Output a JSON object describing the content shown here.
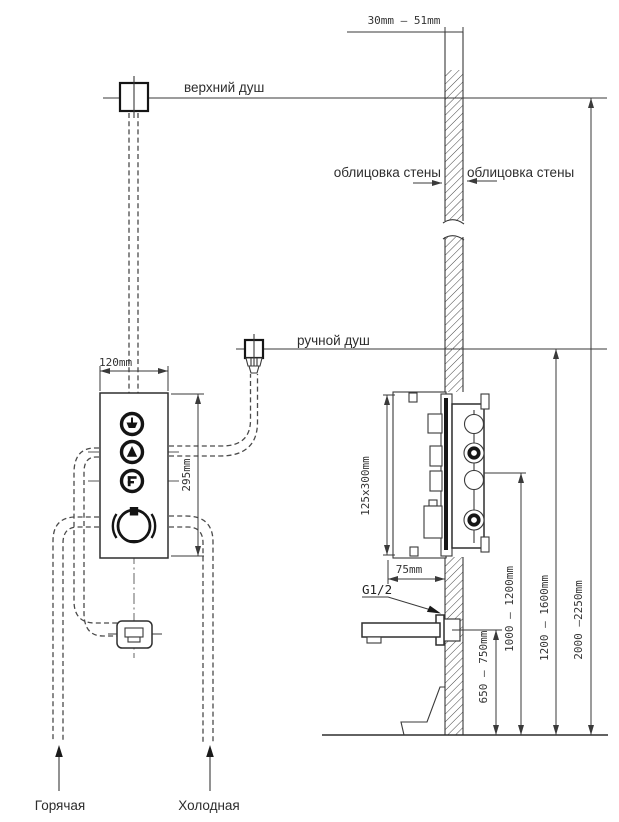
{
  "title": "Схема установки душевой панели",
  "labels": {
    "top_shower": "верхний душ",
    "hand_shower": "ручной душ",
    "wall_cladding_left": "облицовка стены",
    "wall_cladding_right": "облицовка стены",
    "hot_supply": "Горячая",
    "cold_supply": "Холодная",
    "thread": "G1/2"
  },
  "dimensions": {
    "wall_thickness": "30mm  –  51mm",
    "panel_width": "120mm",
    "panel_height": "295mm",
    "box_size": "125x300mm",
    "box_depth": "75mm",
    "spout_height": "650 – 750mm",
    "outlet_height": "1000 – 1200mm",
    "hand_shower_height": "1200 – 1600mm",
    "top_shower_height": "2000 –2250mm"
  }
}
